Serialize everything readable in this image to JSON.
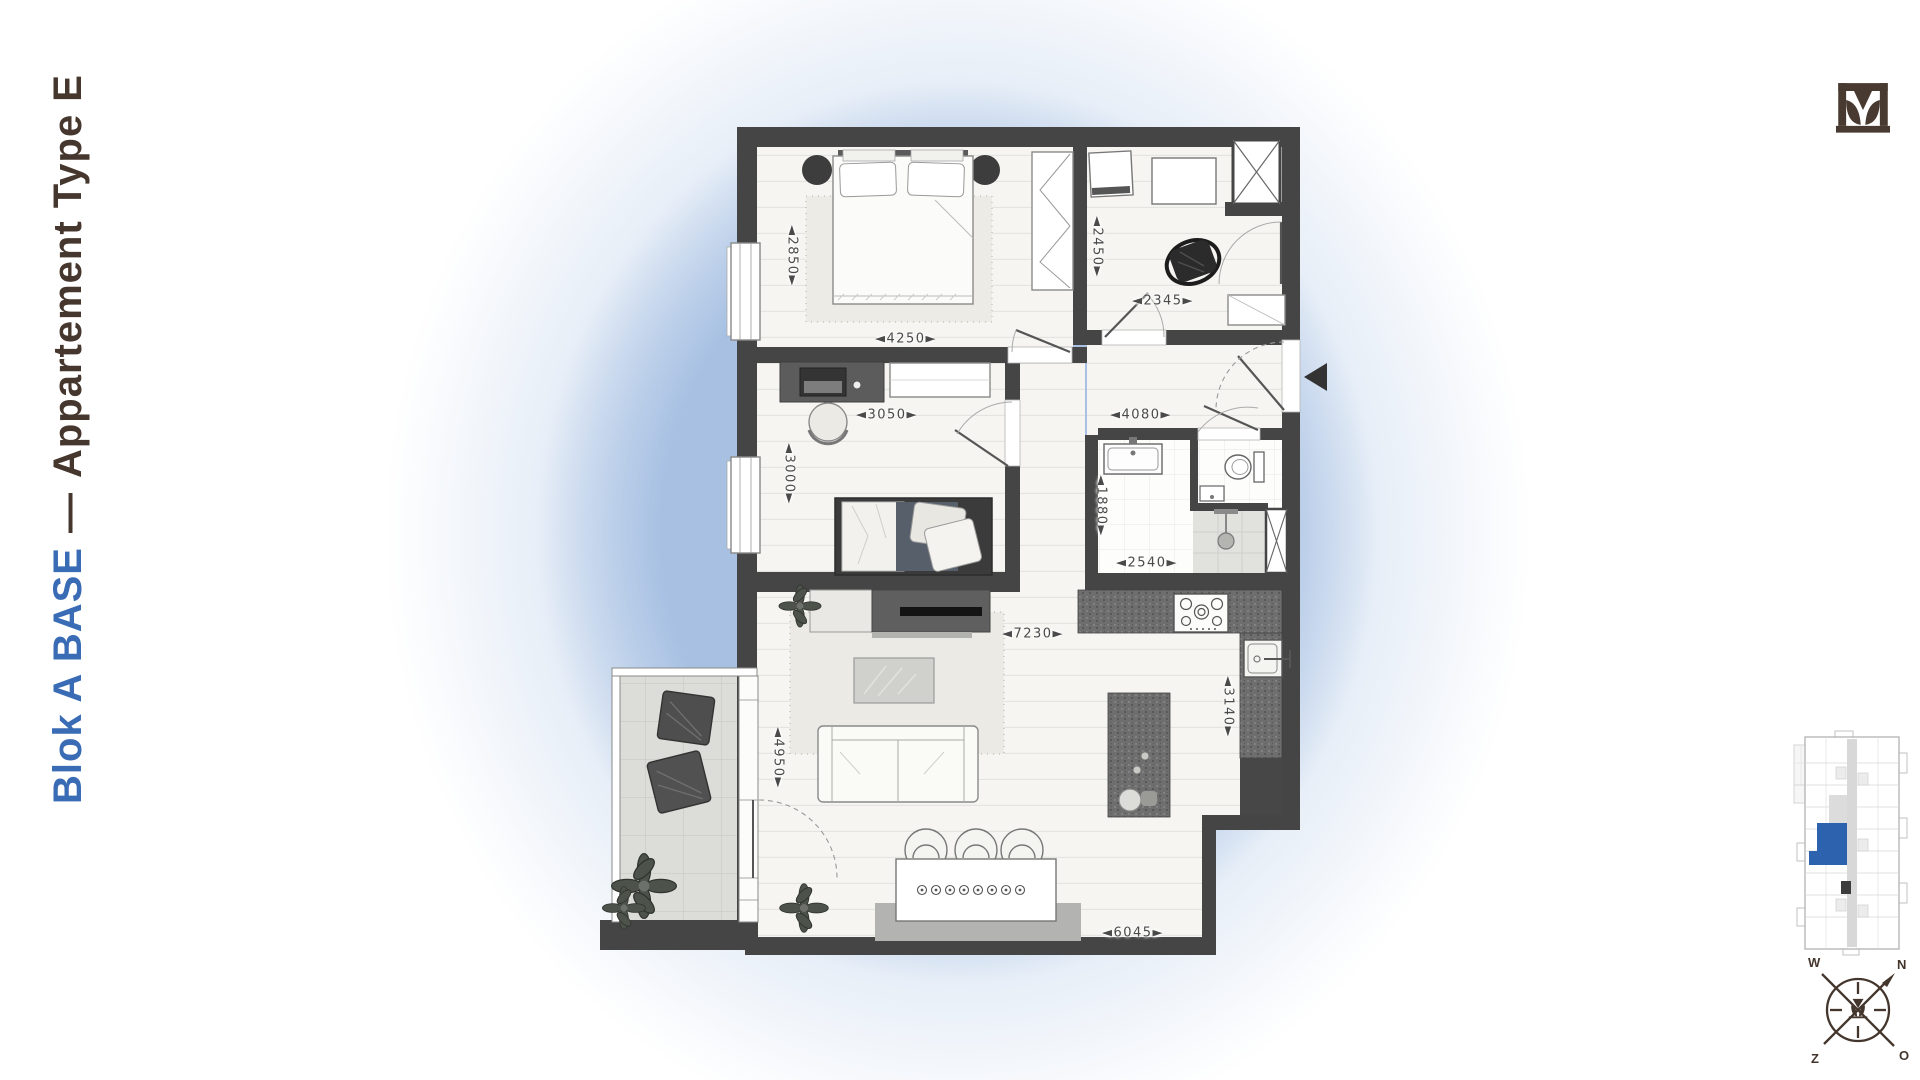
{
  "title": {
    "project": "Blok A BASE",
    "separator": "—",
    "name": "Appartement Type E"
  },
  "dims": {
    "master_depth": "◄2850►",
    "master_width": "◄4250►",
    "utility_depth": "◄2450►",
    "utility_width": "◄2345►",
    "bedroom2_width": "◄3050►",
    "bedroom2_depth": "◄3000►",
    "hall_width": "◄4080►",
    "bathroom_depth": "◄1880►",
    "bathroom_width": "◄2540►",
    "living_width": "◄7230►",
    "kitchen_depth": "◄3140►",
    "living_depth": "◄4950►",
    "dining_width": "◄6045►"
  },
  "compass": {
    "north": "N",
    "west": "W",
    "south": "Z",
    "east": "O"
  },
  "icons": {
    "logo": "tulip-brand-logo",
    "entrance_marker": "solid-left-triangle",
    "shaft_marker": "x-cross-shaft",
    "compass": "compass-rose"
  },
  "colors": {
    "title_blue": "#3a6cb5",
    "title_brown": "#46372e",
    "wall": "#454545",
    "highlight_unit_blue": "#2d62af",
    "halo_blue": "#b9cde9",
    "logo_brown": "#483a30"
  }
}
